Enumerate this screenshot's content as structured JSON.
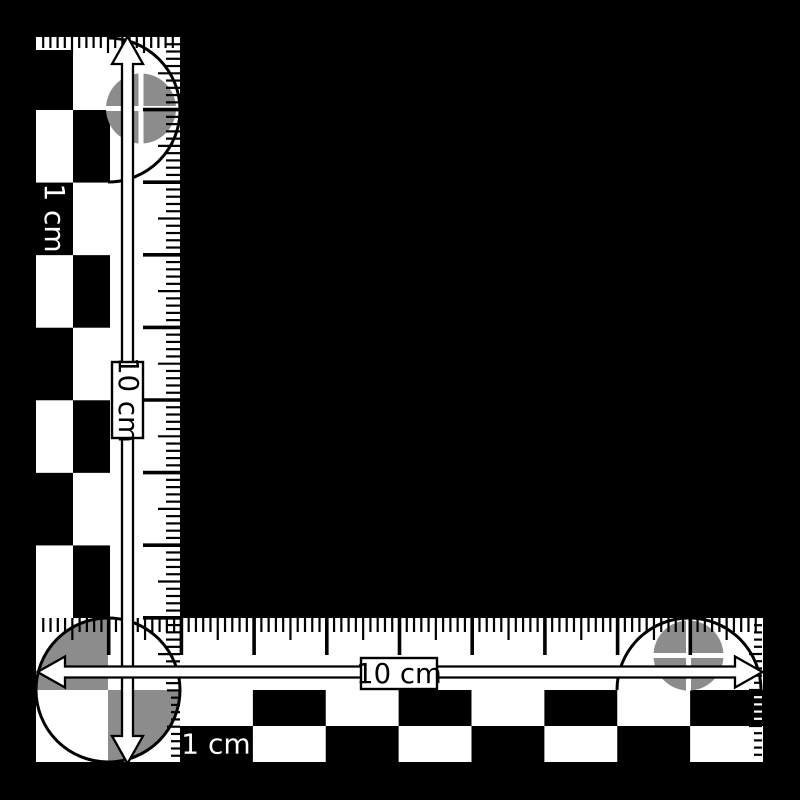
{
  "colors": {
    "background": "#000000",
    "bar_white": "#ffffff",
    "bar_black": "#000000",
    "target_gray": "#8c8c8c"
  },
  "vertical_arm": {
    "arrow_label": "10 cm",
    "unit_label": "1 cm"
  },
  "horizontal_arm": {
    "arrow_label": "10 cm",
    "unit_label": "1 cm"
  }
}
